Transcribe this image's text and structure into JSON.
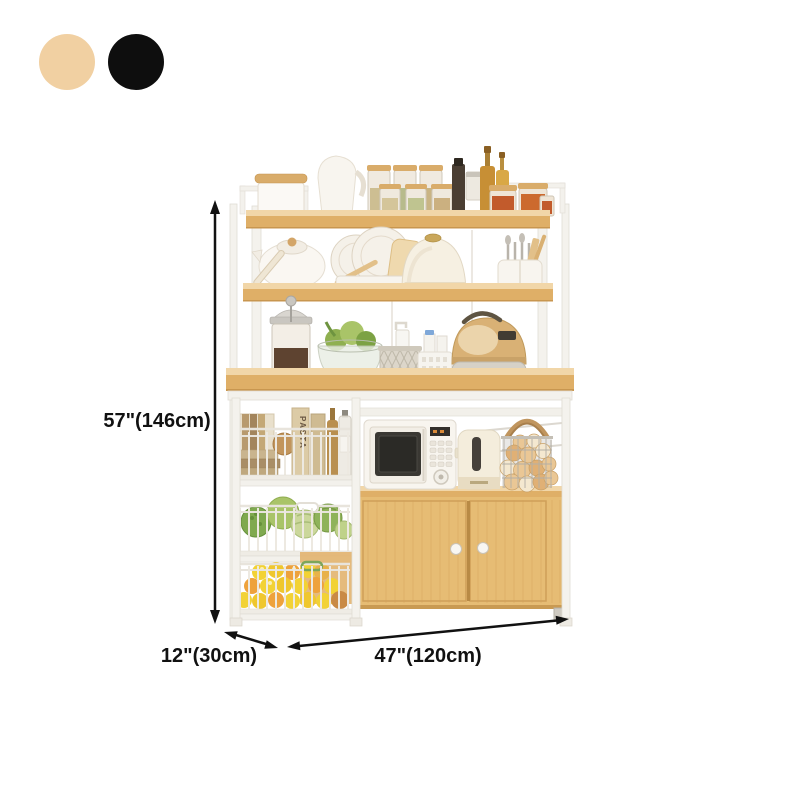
{
  "swatches": {
    "options": [
      {
        "name": "beige",
        "color": "#F1D0A2"
      },
      {
        "name": "black",
        "color": "#0E0E0E"
      }
    ]
  },
  "dimensions": {
    "height": "57\"(146cm)",
    "depth": "12\"(30cm)",
    "width": "47\"(120cm)"
  },
  "labels": {
    "pasta_box": "PASTA"
  },
  "palette": {
    "annotation": "#111111",
    "frame_white": "#F4F2ED",
    "wood_top": "#F1D6A8",
    "wood_front": "#DFAF67",
    "cabinet_body": "#E6BC74",
    "cabinet_door": "#E9C07A"
  },
  "scene": {
    "alt": "Kitchen baker's rack with hutch shelves, countertop appliances, wire baskets and two-door cabinet",
    "items": [
      "canister",
      "pitcher",
      "spice-jars",
      "oil-bottles",
      "teapot",
      "dish-rack",
      "bread-box",
      "utensil-caddy",
      "french-press",
      "salad-bowl",
      "mesh-basket",
      "storage-basket",
      "rice-cooker",
      "books",
      "pasta-boxes",
      "bottles",
      "microwave",
      "toaster",
      "bread-basket",
      "vegetable-basket",
      "fruit-basket",
      "cabinet"
    ]
  }
}
